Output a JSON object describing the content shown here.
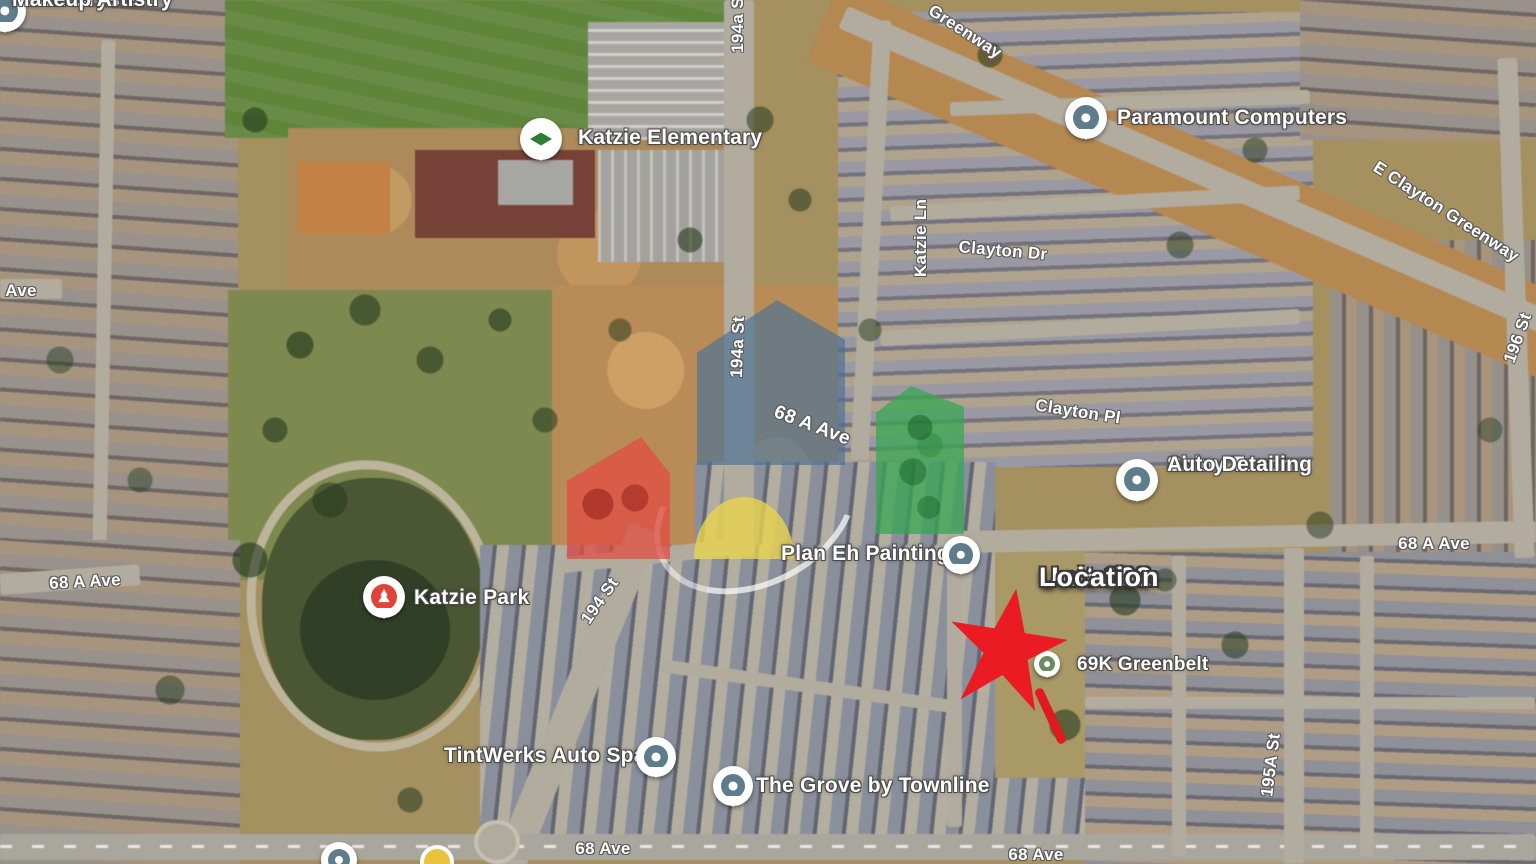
{
  "annotation": {
    "line1": "Unit 102",
    "line2": "Location"
  },
  "pois": [
    {
      "line1": "Fawn Crystal",
      "line2": "Makeup Artistry"
    },
    {
      "name": "Katzie Elementary"
    },
    {
      "name": "Paramount Computers"
    },
    {
      "line1": "Shiny Touch",
      "line2": "Auto Detailing"
    },
    {
      "name": "Katzie Park"
    },
    {
      "name": "Plan Eh Painting"
    },
    {
      "name": "TintWerks Auto Spa"
    },
    {
      "name": "The Grove by Townline"
    },
    {
      "name": "69K Greenbelt"
    }
  ],
  "roads": [
    {
      "label": "Greenway"
    },
    {
      "label": "194a St"
    },
    {
      "label": "194a St"
    },
    {
      "label": "Katzie Ln"
    },
    {
      "label": "Clayton Dr"
    },
    {
      "label": "Clayton Pl"
    },
    {
      "label": "68 A Ave"
    },
    {
      "label": "E Clayton Greenway"
    },
    {
      "label": "196 St"
    },
    {
      "label": "68 A Ave"
    },
    {
      "label": "Ave"
    },
    {
      "label": "68 A Ave"
    },
    {
      "label": "194 St"
    },
    {
      "label": "195A St"
    },
    {
      "label": "68 Ave"
    },
    {
      "label": "68 Ave"
    }
  ],
  "colors": {
    "star": "#ea1b22",
    "logo_red": "#e24c44",
    "logo_blue": "#4a7297",
    "logo_yellow": "#e9d44d",
    "logo_green": "#3ba654"
  }
}
